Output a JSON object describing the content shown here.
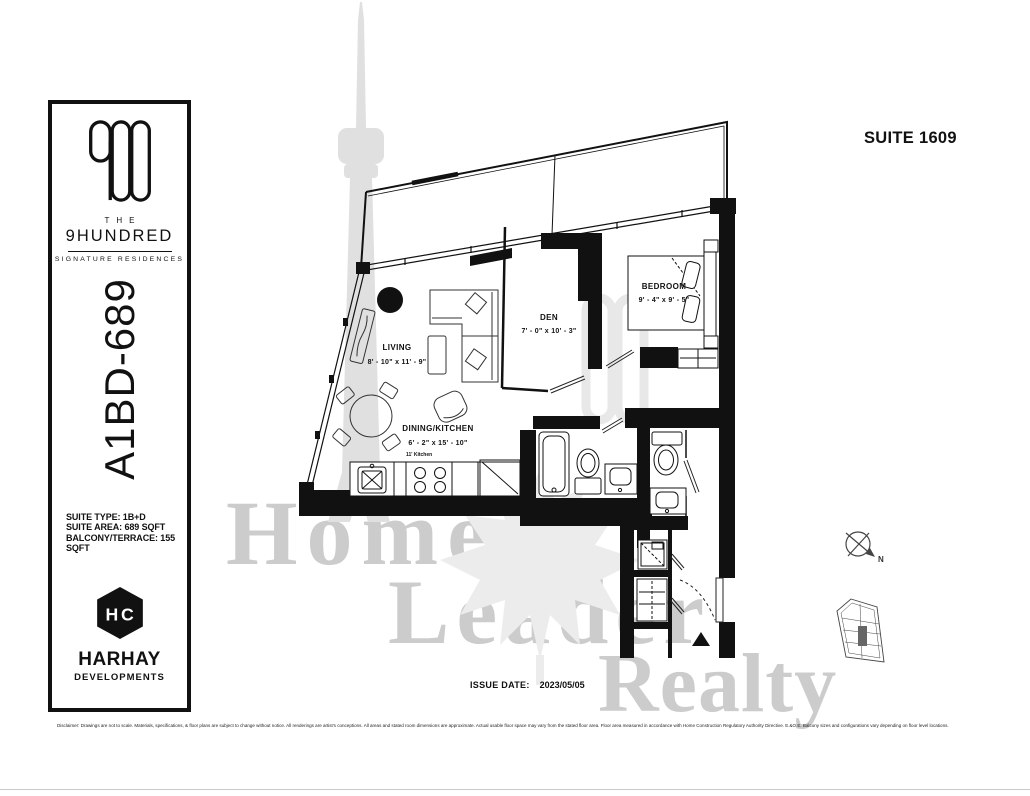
{
  "sidebar": {
    "brand": {
      "logo": "900-logo",
      "the": "THE",
      "name": "9HUNDRED",
      "tagline": "SIGNATURE RESIDENCES"
    },
    "plan_code": "A1BD-689",
    "specs": {
      "suite_type": "SUITE TYPE: 1B+D",
      "suite_area": "SUITE AREA: 689 SQFT",
      "balcony": "BALCONY/TERRACE: 155 SQFT"
    },
    "developer": {
      "logo": "hc-cube-icon",
      "name": "HARHAY",
      "subtitle": "DEVELOPMENTS"
    }
  },
  "header": {
    "suite_title": "SUITE 1609"
  },
  "floorplan": {
    "rooms": {
      "living": {
        "name": "LIVING",
        "dims": "8' - 10\" x 11' - 9\""
      },
      "den": {
        "name": "DEN",
        "dims": "7' - 0\" x 10' - 3\""
      },
      "bedroom": {
        "name": "BEDROOM",
        "dims": "9' - 4\" x 9' - 5\""
      },
      "dining_kitchen": {
        "name": "DINING/KITCHEN",
        "dims": "6' - 2\" x 15' - 10\""
      }
    },
    "kitchen_note": "11' Kitchen",
    "compass_label": "N"
  },
  "footer": {
    "issue_label": "ISSUE DATE:",
    "issue_value": "2023/05/05",
    "disclaimer": "Disclaimer: Drawings are not to scale. Materials, specifications, & floor plans are subject to change without notice. All renderings are artist's conceptions. All areas and stated room dimensions are approximate. Actual usable floor space may vary from the stated floor area. Floor area measured in accordance with Home Construction Regulatory Authority Directive. E.&O.E. Balcony sizes and configurations vary depending on floor level locations."
  },
  "watermark": {
    "line1": "Home",
    "line2": "Leader",
    "line3": "Realty"
  },
  "colors": {
    "wall": "#111111",
    "watermark_gray": "#cccccc"
  }
}
